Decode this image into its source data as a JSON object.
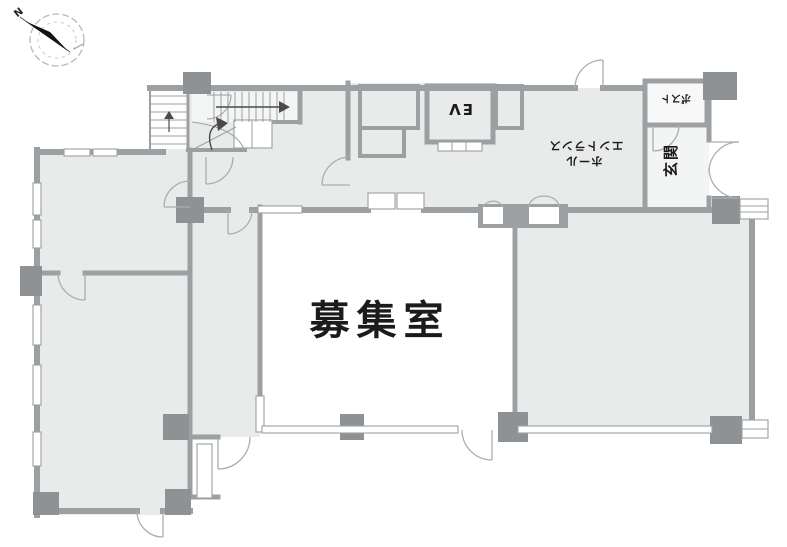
{
  "document_type": "building-floor-plan",
  "compass": {
    "north_label": "N"
  },
  "labels": {
    "vacant_room": "募集室",
    "elevator": "EV",
    "entrance_hall": "エントランスホール",
    "entrance_hall_line_top": "エントランス",
    "entrance_hall_line_bottom": "ホール",
    "entrance": "玄関",
    "mailbox": "ポスト"
  },
  "colors": {
    "room_fill": "#e9eaea",
    "wall": "#9ca0a2",
    "pillar": "#8e9294",
    "thin_line": "#aaadb0",
    "text": "#1b1b1b",
    "background": "#ffffff"
  }
}
